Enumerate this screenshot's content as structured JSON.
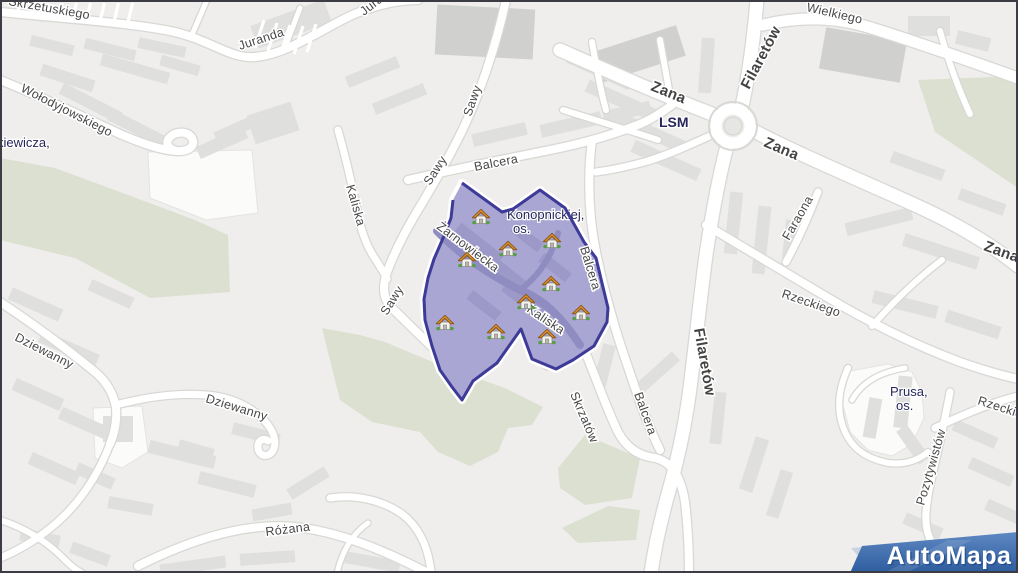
{
  "app": {
    "provider_watermark": "AutoMapa"
  },
  "map": {
    "background": "#efeeec",
    "road_color": "#ffffff",
    "road_casing": "#d8d8d5",
    "green_color": "#dce0d1",
    "building_color": "#dfdfdd",
    "street_label_color": "#474747",
    "district_label_color": "#26265c",
    "region": {
      "name": "Konopnickiej, os.",
      "fill": "#a9a6d3",
      "border": "#3d3a98",
      "points": "462,183 502,212 513,209 540,190 565,208 584,242 596,258 608,308 607,322 594,346 573,360 556,369 532,359 521,329 497,363 473,381 462,400 452,387 440,370 432,346 425,320 424,299 428,278 434,259 444,236 451,218 453,200"
    },
    "houses": [
      [
        481,
        217
      ],
      [
        552,
        241
      ],
      [
        508,
        249
      ],
      [
        467,
        260
      ],
      [
        551,
        284
      ],
      [
        526,
        302
      ],
      [
        581,
        313
      ],
      [
        445,
        323
      ],
      [
        496,
        332
      ],
      [
        547,
        337
      ]
    ],
    "labels": {
      "streets": [
        {
          "text": "Skrzetuskiego",
          "x": 8,
          "y": 5,
          "rot": 10,
          "major": false
        },
        {
          "text": "Juranda",
          "x": 240,
          "y": 50,
          "rot": -18,
          "major": false
        },
        {
          "text": "Juranda",
          "x": 364,
          "y": 16,
          "rot": -38,
          "major": false
        },
        {
          "text": "Wołodyjowskiego",
          "x": 20,
          "y": 91,
          "rot": 27,
          "major": false
        },
        {
          "text": "Sawy",
          "x": 471,
          "y": 117,
          "rot": -71,
          "major": false
        },
        {
          "text": "Sawy",
          "x": 430,
          "y": 186,
          "rot": -57,
          "major": false
        },
        {
          "text": "Sawy",
          "x": 387,
          "y": 316,
          "rot": -58,
          "major": false
        },
        {
          "text": "Kaliska",
          "x": 346,
          "y": 186,
          "rot": 74,
          "major": false
        },
        {
          "text": "Balcera",
          "x": 475,
          "y": 171,
          "rot": -11,
          "major": false
        },
        {
          "text": "Balcera",
          "x": 580,
          "y": 248,
          "rot": 73,
          "major": false
        },
        {
          "text": "Balcera",
          "x": 634,
          "y": 394,
          "rot": 70,
          "major": false
        },
        {
          "text": "Skrzatów",
          "x": 570,
          "y": 394,
          "rot": 67,
          "major": false
        },
        {
          "text": "Żarnowiecka",
          "x": 436,
          "y": 228,
          "rot": 37,
          "major": false
        },
        {
          "text": "Kaliska",
          "x": 526,
          "y": 311,
          "rot": 34,
          "major": false
        },
        {
          "text": "Zana",
          "x": 650,
          "y": 90,
          "rot": 22,
          "major": true
        },
        {
          "text": "Zana",
          "x": 763,
          "y": 146,
          "rot": 23,
          "major": true
        },
        {
          "text": "Zana",
          "x": 983,
          "y": 250,
          "rot": 20,
          "major": true
        },
        {
          "text": "Filaretów",
          "x": 749,
          "y": 90,
          "rot": -62,
          "major": true
        },
        {
          "text": "Filaretów",
          "x": 694,
          "y": 329,
          "rot": 80,
          "major": true
        },
        {
          "text": "Wielkiego",
          "x": 806,
          "y": 11,
          "rot": 13,
          "major": false
        },
        {
          "text": "Faraona",
          "x": 789,
          "y": 241,
          "rot": -60,
          "major": false
        },
        {
          "text": "Rzeckiego",
          "x": 781,
          "y": 297,
          "rot": 19,
          "major": false
        },
        {
          "text": "Rzeckiego",
          "x": 977,
          "y": 404,
          "rot": 18,
          "major": false
        },
        {
          "text": "Pozytywistów",
          "x": 924,
          "y": 506,
          "rot": -74,
          "major": false
        },
        {
          "text": "Dziewanny",
          "x": 14,
          "y": 340,
          "rot": 27,
          "major": false
        },
        {
          "text": "Dziewanny",
          "x": 205,
          "y": 402,
          "rot": 17,
          "major": false
        },
        {
          "text": "Różana",
          "x": 266,
          "y": 536,
          "rot": -7,
          "major": false
        }
      ],
      "districts": [
        {
          "lines": [
            "kiewicza,"
          ],
          "x": -3,
          "y": 147,
          "bold": false
        },
        {
          "lines": [
            "LSM"
          ],
          "x": 659,
          "y": 127,
          "bold": true
        },
        {
          "lines": [
            "Konopnickiej,",
            "os."
          ],
          "x": 507,
          "y": 219,
          "bold": false
        },
        {
          "lines": [
            "Prusa,",
            "os."
          ],
          "x": 890,
          "y": 396,
          "bold": false
        }
      ]
    },
    "logo": {
      "text": "AutoMapa",
      "blue_top": "#5e88c2",
      "blue_bottom": "#2d5c9e"
    }
  }
}
